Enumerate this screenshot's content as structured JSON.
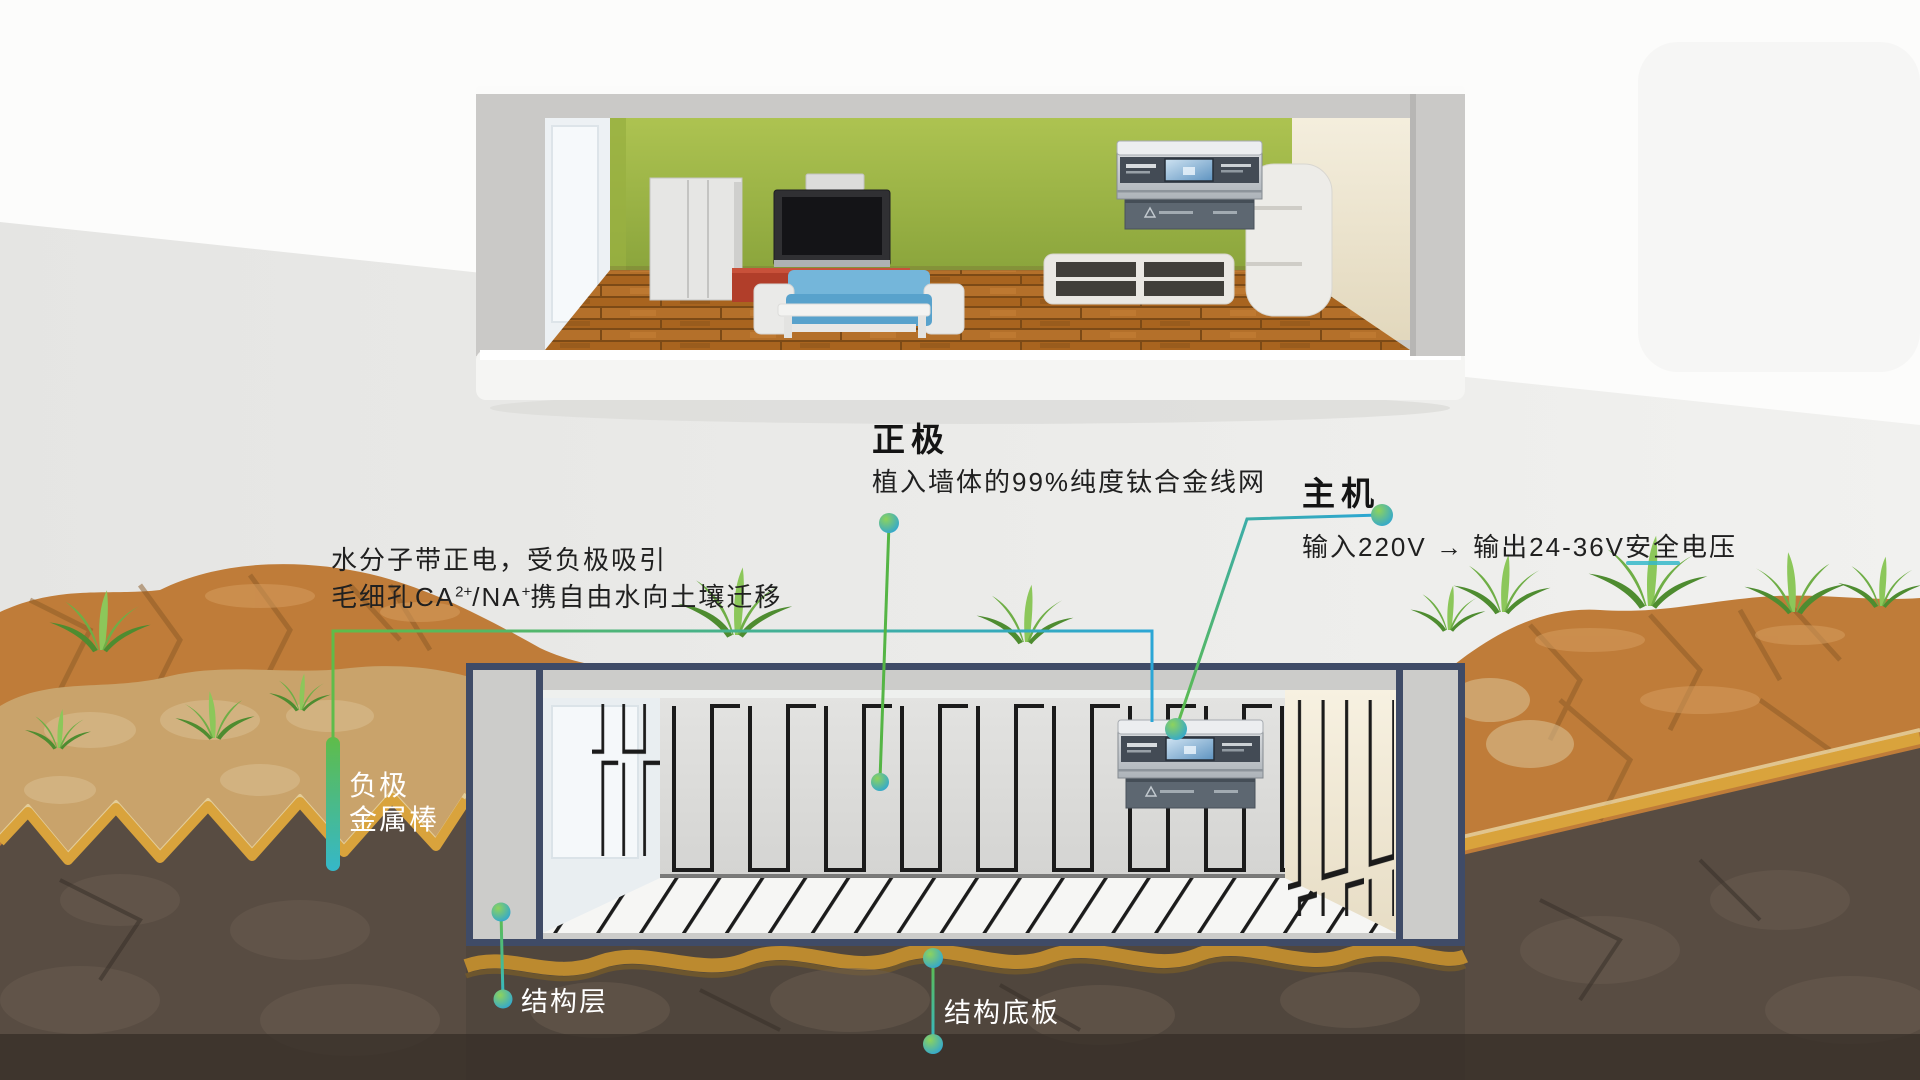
{
  "diagram": {
    "positive": {
      "title": "正极",
      "desc": "植入墙体的99%纯度钛合金线网"
    },
    "host": {
      "title": "主机",
      "desc": "输入220V → 输出24-36V安全电压"
    },
    "water": {
      "line1": "水分子带正电，受负极吸引",
      "line2_parts": [
        "毛细孔CA",
        "2+",
        "/NA",
        "+",
        "携自由水向土壤迁移"
      ]
    },
    "negative": {
      "line1": "负极",
      "line2": "金属棒"
    },
    "structure_layer": "结构层",
    "structure_slab": "结构底板"
  },
  "colors": {
    "connector_green": "#5fbc49",
    "connector_cyan": "#2ba6d6",
    "structure_navy": "#3f4b67",
    "frame_gray": "#ccccca",
    "wall_green": "#9db544",
    "soil_orange": "#bf7c39",
    "soil_tan": "#c9a36b",
    "soil_dark": "#584c42",
    "trim_gold": "#d9a33c",
    "wire_black": "#1b1b1b"
  }
}
